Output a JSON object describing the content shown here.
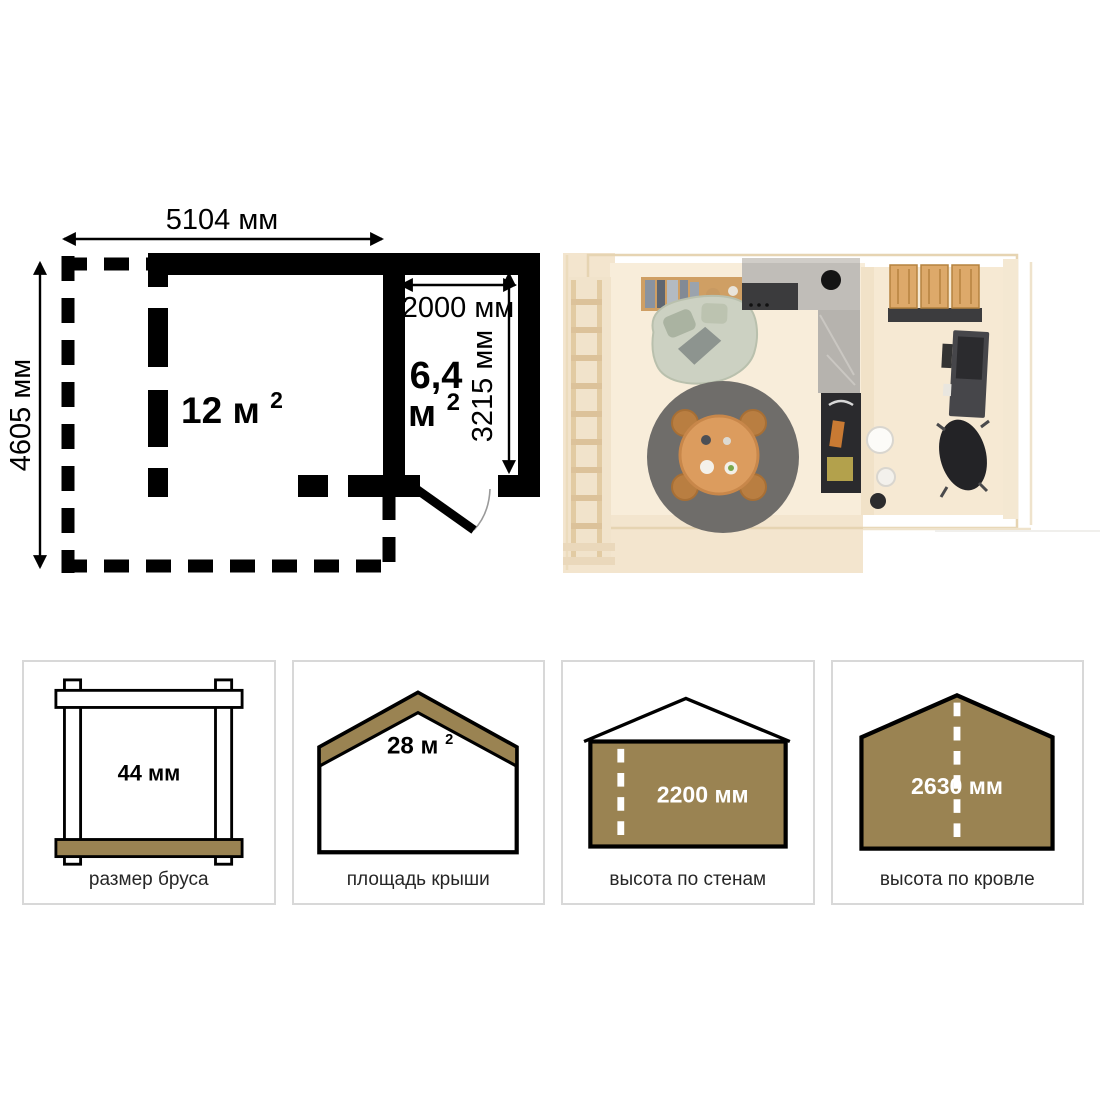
{
  "plan": {
    "dim_width": "5104 мм",
    "dim_height": "4605 мм",
    "main_room": {
      "area_value": "12 м",
      "area_sup": "2"
    },
    "small_room": {
      "area_value": "6,4",
      "area_unit": "м",
      "area_sup": "2",
      "dim_width": "2000 мм",
      "dim_height": "3215 мм"
    }
  },
  "specs_cards": [
    {
      "icon": "beam-frame-icon",
      "value": "44 мм",
      "label": "размер бруса"
    },
    {
      "icon": "roof-area-icon",
      "value": "28 м",
      "value_sup": "2",
      "label": "площадь крыши"
    },
    {
      "icon": "wall-height-icon",
      "value": "2200 мм",
      "label": "высота по стенам"
    },
    {
      "icon": "roof-height-icon",
      "value": "2630 мм",
      "label": "высота по кровле"
    }
  ],
  "colors": {
    "accent_brown": "#9a8352",
    "plan_line": "#000000",
    "card_border": "#d8d8d8",
    "value_text_light": "#ffffff",
    "label_text": "#262626"
  }
}
